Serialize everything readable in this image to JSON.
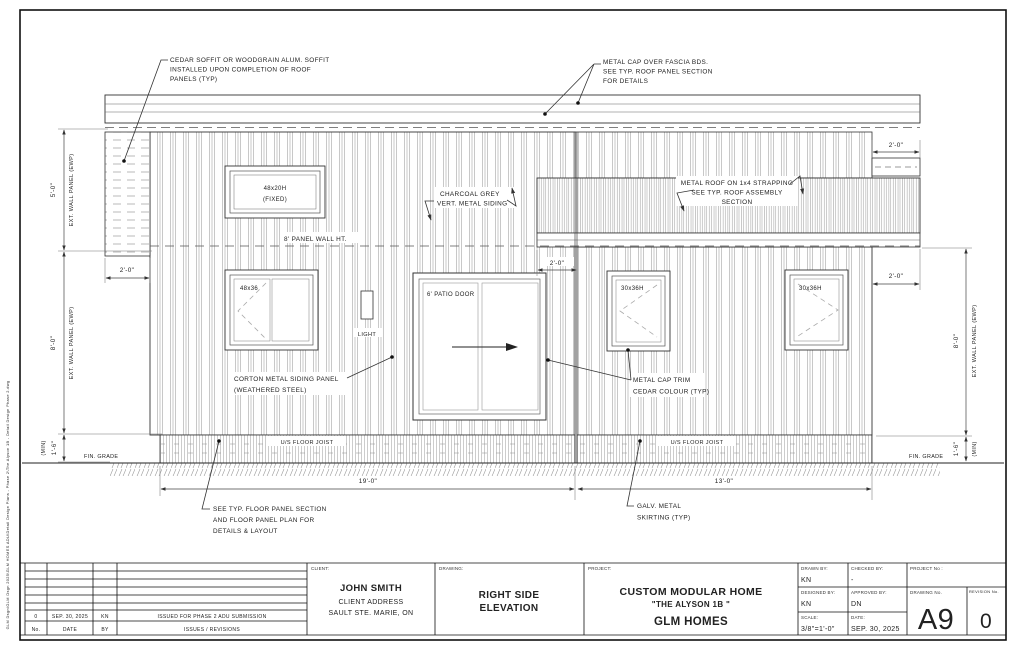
{
  "sheet": {
    "side_file_path": "GLM Dsgn\\GLM Dsgn 2025\\GLM HOMES ADU\\Detail Design Plans - Phase 2\\The Alyson 1B - Detail Design Phase 2.dwg"
  },
  "notes": {
    "cedar_soffit": [
      "CEDAR SOFFIT OR WOODGRAIN ALUM. SOFFIT",
      "INSTALLED UPON COMPLETION OF ROOF",
      "PANELS (TYP)"
    ],
    "metal_cap": [
      "METAL CAP OVER FASCIA BDS.",
      "SEE TYP. ROOF PANEL SECTION",
      "FOR DETAILS"
    ],
    "charcoal_siding": [
      "CHARCOAL GREY",
      "VERT. METAL SIDING"
    ],
    "metal_roof": [
      "METAL ROOF ON 1x4 STRAPPING",
      "SEE TYP. ROOF ASSEMBLY",
      "SECTION"
    ],
    "panel_wall_ht": "8' PANEL WALL HT.",
    "corton_panel": [
      "CORTON METAL SIDING PANEL",
      "(WEATHERED STEEL)"
    ],
    "cap_trim": [
      "METAL CAP TRIM",
      "CEDAR COLOUR (TYP)"
    ],
    "floor_panel": [
      "SEE TYP. FLOOR PANEL SECTION",
      "AND FLOOR PANEL PLAN FOR",
      "DETAILS & LAYOUT"
    ],
    "skirting": [
      "GALV. METAL",
      "SKIRTING (TYP)"
    ],
    "us_floor_joist": "U/S FLOOR JOIST",
    "fin_grade": "FIN. GRADE"
  },
  "fixtures": {
    "window_fixed": [
      "48x20H",
      "(FIXED)"
    ],
    "window_48x36": "48x36",
    "window_30x36h": "30x36H",
    "patio_door": "6' PATIO DOOR",
    "light": "LIGHT"
  },
  "dims": {
    "w5": "5'-0\"",
    "w8": "8'-0\"",
    "ewp": "EXT. WALL PANEL (EWP)",
    "h16": "1'-6\"",
    "min": "(MIN)",
    "d2": "2'-0\"",
    "d19": "19'-0\"",
    "d13": "13'-0\""
  },
  "titleblock": {
    "client_label": "CLIENT:",
    "client_name": "JOHN SMITH",
    "client_addr1": "CLIENT ADDRESS",
    "client_addr2": "SAULT STE. MARIE, ON",
    "drawing_label": "DRAWING:",
    "drawing_name1": "RIGHT SIDE",
    "drawing_name2": "ELEVATION",
    "project_label": "PROJECT:",
    "project_name1": "CUSTOM MODULAR HOME",
    "project_name2": "\"THE ALYSON 1B \"",
    "project_name3": "GLM HOMES",
    "drawn_by_label": "DRAWN BY:",
    "drawn_by": "KN",
    "checked_label": "CHECKED BY:",
    "checked": "-",
    "project_no_label": "PROJECT No :",
    "designed_label": "DESIGNED BY:",
    "designed": "KN",
    "approved_label": "APPROVED BY:",
    "approved": "DN",
    "scale_label": "SCALE:",
    "scale": "3/8\"=1'-0\"",
    "date_label": "DATE:",
    "date": "SEP. 30, 2025",
    "drawing_no_label": "DRAWING No.",
    "drawing_no": "A9",
    "revision_label": "REVISION No.",
    "revision": "0",
    "rev_row": {
      "no": "0",
      "date": "SEP. 30, 2025",
      "by": "KN",
      "desc": "ISSUED FOR PHASE 2 ADU SUBMISSION"
    },
    "rev_header": {
      "no": "No.",
      "date": "DATE",
      "by": "BY",
      "desc": "ISSUES / REVISIONS"
    }
  }
}
